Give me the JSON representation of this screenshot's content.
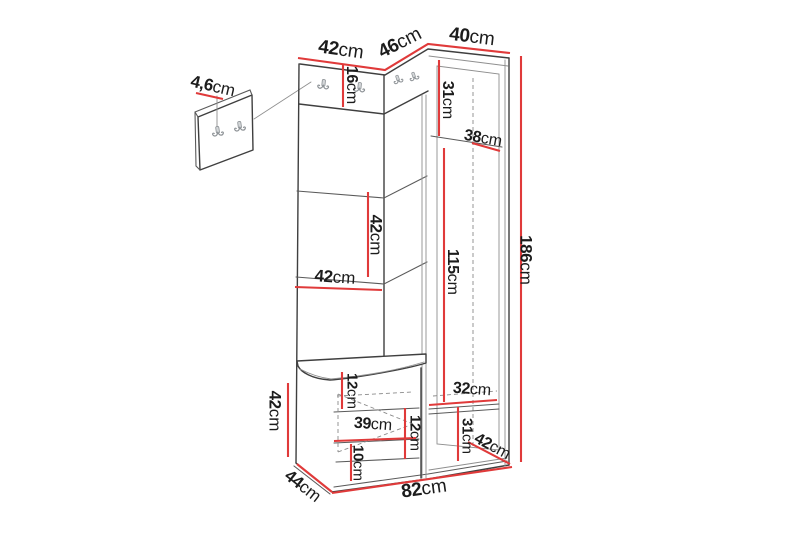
{
  "page": {
    "background": "#ffffff",
    "width_px": 800,
    "height_px": 533
  },
  "diagram": {
    "type": "furniture-dimension-drawing",
    "subject": "corner hallway unit with coat hooks, open shelves, shoe bench and tall wardrobe cabinet, plus a separate small wall hook panel",
    "unit": "cm",
    "colors": {
      "dimension_line": "#e03a3a",
      "outline": "#3f3f3f",
      "thin_line": "#8f8f8f",
      "hook": "#8d9296",
      "background": "#ffffff"
    },
    "dims": {
      "panel_hook_size": {
        "value": "4,6",
        "unit": "cm"
      },
      "top_width_left": {
        "value": "42",
        "unit": "cm"
      },
      "top_width_corner": {
        "value": "46",
        "unit": "cm"
      },
      "top_width_right": {
        "value": "40",
        "unit": "cm"
      },
      "hook_panel_height": {
        "value": "16",
        "unit": "cm"
      },
      "cabinet_top_compartment": {
        "value": "31",
        "unit": "cm"
      },
      "cabinet_shelf_depth": {
        "value": "38",
        "unit": "cm"
      },
      "middle_compartment_height": {
        "value": "42",
        "unit": "cm"
      },
      "compartment_width": {
        "value": "42",
        "unit": "cm"
      },
      "cabinet_interior_height": {
        "value": "115",
        "unit": "cm"
      },
      "total_height": {
        "value": "186",
        "unit": "cm"
      },
      "bench_height": {
        "value": "42",
        "unit": "cm"
      },
      "bench_top_clearance": {
        "value": "12",
        "unit": "cm"
      },
      "bench_opening_width": {
        "value": "39",
        "unit": "cm"
      },
      "bench_right_clearance": {
        "value": "12",
        "unit": "cm"
      },
      "bench_bottom_clearance": {
        "value": "10",
        "unit": "cm"
      },
      "cabinet_bottom_width": {
        "value": "32",
        "unit": "cm"
      },
      "cabinet_bottom_compartment": {
        "value": "31",
        "unit": "cm"
      },
      "cabinet_bottom_depth": {
        "value": "42",
        "unit": "cm"
      },
      "bench_depth": {
        "value": "44",
        "unit": "cm"
      },
      "total_width": {
        "value": "82",
        "unit": "cm"
      }
    }
  }
}
